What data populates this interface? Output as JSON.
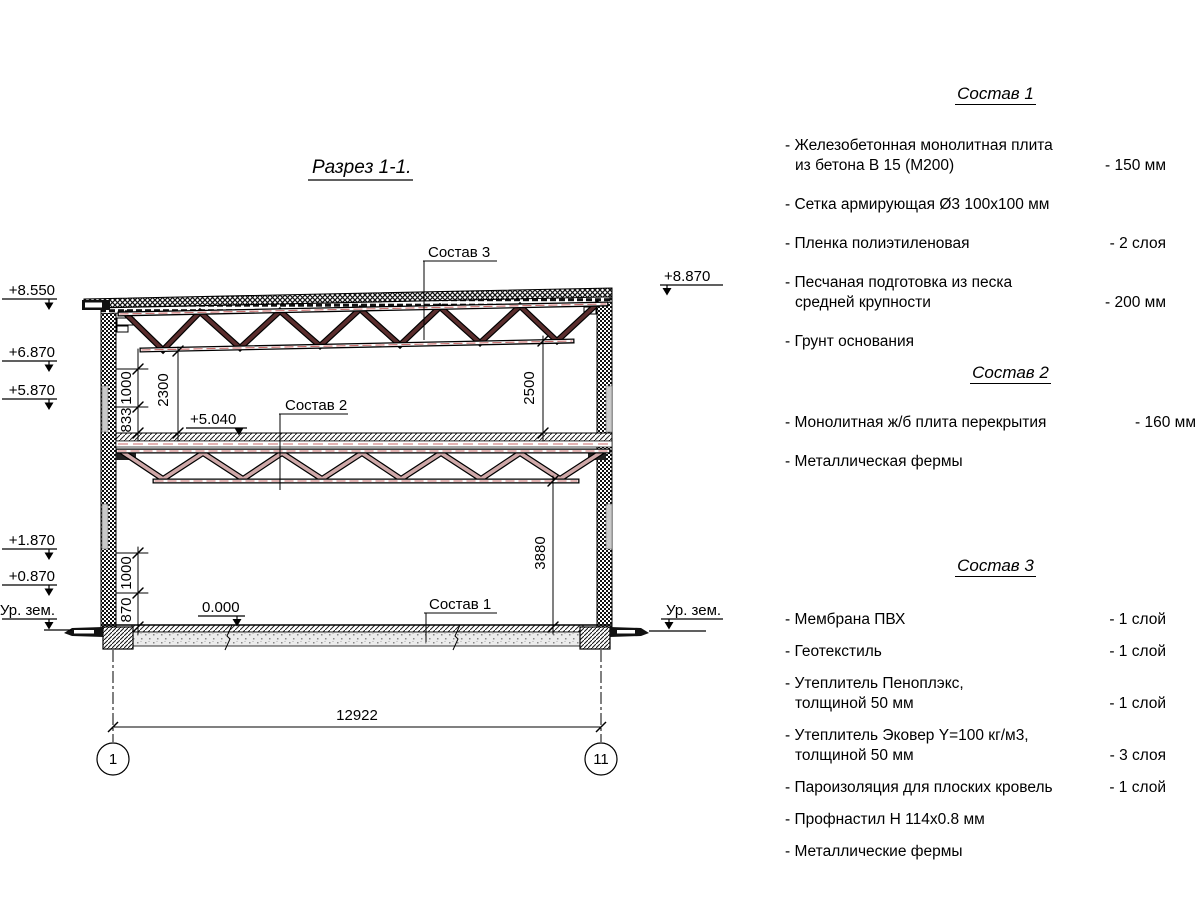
{
  "colors": {
    "truss_primary": "#5a2d2d",
    "truss_secondary": "#cfa8a8",
    "centerline": "#c96a6a"
  },
  "drawing": {
    "title": "Разрез 1-1.",
    "labels": {
      "s1": "Состав 1",
      "s2": "Состав 2",
      "s3": "Состав 3"
    },
    "elev": {
      "e8550": "+8.550",
      "e6870": "+6.870",
      "e5870": "+5.870",
      "e1870": "+1.870",
      "e0870": "+0.870",
      "ground_left": "Ур. зем.",
      "e8870": "+8.870",
      "ground_right": "Ур. зем.",
      "e5040": "+5.040",
      "e0000": "0.000"
    },
    "dims": {
      "upper_1000": "1000",
      "upper_833": "833",
      "truss_2300": "2300",
      "truss_2500": "2500",
      "lower_1000": "1000",
      "lower_870": "870",
      "right_3880": "3880",
      "overall": "12922"
    },
    "axes": {
      "left": "1",
      "right": "11"
    }
  },
  "compositions": [
    {
      "title": "Состав 1",
      "items": [
        {
          "text": "- Железобетонная  монолитная плита",
          "text2": "из бетона В 15 (М200)",
          "value": "- 150 мм"
        },
        {
          "text": "- Сетка армирующая Ø3 100х100 мм",
          "text2": "",
          "value": ""
        },
        {
          "text": "- Пленка полиэтиленовая",
          "text2": "",
          "value": "-  2 слоя"
        },
        {
          "text": "- Песчаная подготовка из песка",
          "text2": "средней крупности",
          "value": "- 200 мм"
        },
        {
          "text": "- Грунт основания",
          "text2": "",
          "value": ""
        }
      ]
    },
    {
      "title": "Состав 2",
      "items": [
        {
          "text": "- Монолитная ж/б плита перекрытия",
          "text2": "",
          "value": "- 160 мм"
        },
        {
          "text": "- Металлическая фермы",
          "text2": "",
          "value": ""
        }
      ]
    },
    {
      "title": "Состав 3",
      "items": [
        {
          "text": "- Мембрана ПВХ",
          "text2": "",
          "value": "- 1 слой"
        },
        {
          "text": "- Геотекстиль",
          "text2": "",
          "value": "- 1 слой"
        },
        {
          "text": "- Утеплитель Пеноплэкс,",
          "text2": "толщиной 50 мм",
          "value": "- 1 слой"
        },
        {
          "text": "- Утеплитель Эковер Y=100 кг/м3,",
          "text2": "толщиной 50 мм",
          "value": "- 3 слоя"
        },
        {
          "text": "- Пароизоляция для плоских кровель",
          "text2": "",
          "value": "- 1 слой"
        },
        {
          "text": "- Профнастил Н 114х0.8 мм",
          "text2": "",
          "value": ""
        },
        {
          "text": "- Металлические фермы",
          "text2": "",
          "value": ""
        }
      ]
    }
  ]
}
